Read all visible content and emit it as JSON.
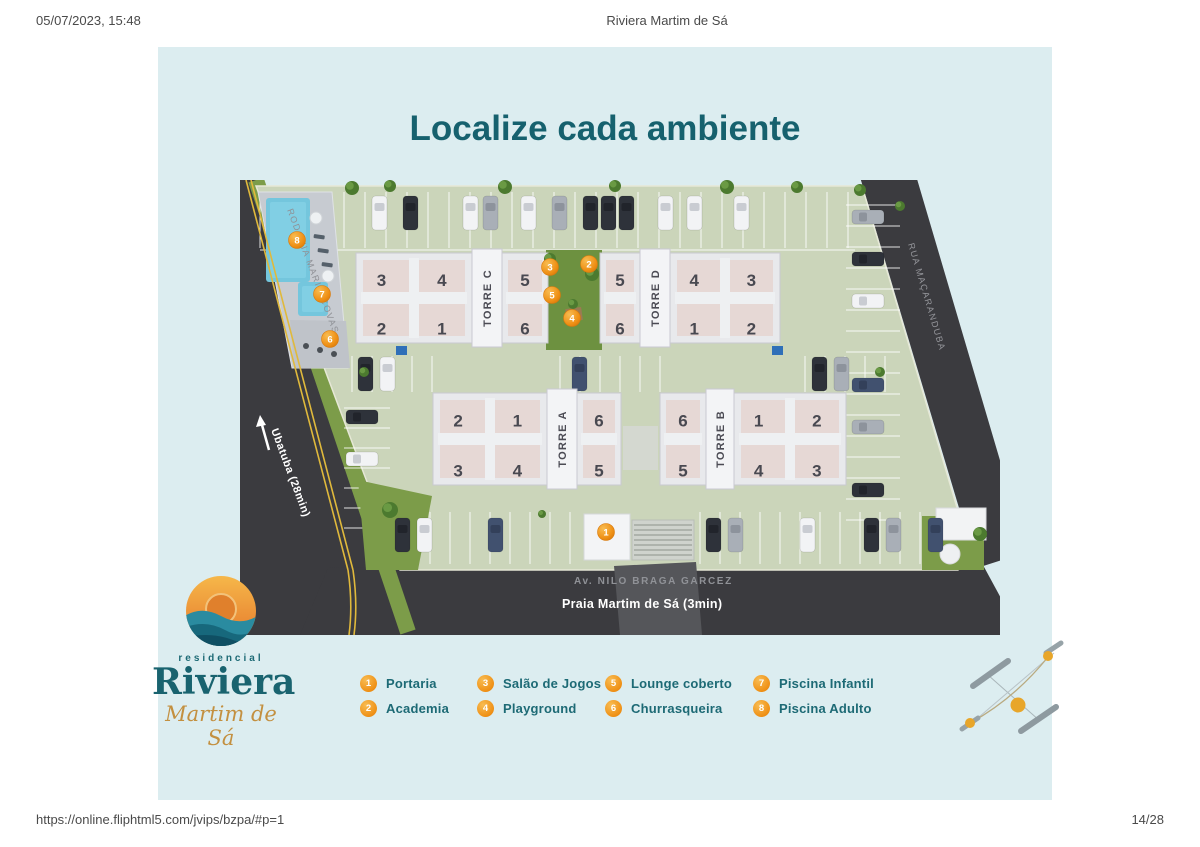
{
  "print_header": {
    "datetime": "05/07/2023, 15:48",
    "title": "Riviera Martim de Sá"
  },
  "print_footer": {
    "url": "https://online.fliphtml5.com/jvips/bzpa/#p=1",
    "page_indicator": "14/28"
  },
  "poster": {
    "title": "Localize cada ambiente",
    "logo": {
      "line1": "residencial",
      "line2": "Riviera",
      "line3": "Martim de Sá"
    },
    "roads": {
      "left": {
        "name": "RODOVIA MARIO COVAS",
        "destination": "Ubatuba (28min)"
      },
      "right": {
        "name": "RUA MAÇARANDUBA"
      },
      "bottom": {
        "name": "Av. NILO BRAGA GARCEZ",
        "destination": "Praia Martim de Sá (3min)"
      }
    },
    "towers": [
      {
        "label": "TORRE C",
        "big_wing_side": "left",
        "big_units": [
          "3",
          "4",
          "2",
          "1"
        ],
        "small_units": [
          "5",
          "6"
        ]
      },
      {
        "label": "TORRE D",
        "big_wing_side": "right",
        "big_units": [
          "4",
          "3",
          "1",
          "2"
        ],
        "small_units": [
          "5",
          "6"
        ]
      },
      {
        "label": "TORRE A",
        "big_wing_side": "left",
        "big_units": [
          "2",
          "1",
          "3",
          "4"
        ],
        "small_units": [
          "6",
          "5"
        ]
      },
      {
        "label": "TORRE B",
        "big_wing_side": "right",
        "big_units": [
          "1",
          "2",
          "4",
          "3"
        ],
        "small_units": [
          "6",
          "5"
        ]
      }
    ],
    "map_markers": [
      {
        "n": "1",
        "x": 366,
        "y": 352
      },
      {
        "n": "2",
        "x": 349,
        "y": 84
      },
      {
        "n": "3",
        "x": 310,
        "y": 87
      },
      {
        "n": "4",
        "x": 332,
        "y": 138
      },
      {
        "n": "5",
        "x": 312,
        "y": 115
      },
      {
        "n": "6",
        "x": 90,
        "y": 159
      },
      {
        "n": "7",
        "x": 82,
        "y": 114
      },
      {
        "n": "8",
        "x": 57,
        "y": 60
      }
    ],
    "legend": [
      {
        "n": "1",
        "label": "Portaria"
      },
      {
        "n": "2",
        "label": "Academia"
      },
      {
        "n": "3",
        "label": "Salão de Jogos"
      },
      {
        "n": "4",
        "label": "Playground"
      },
      {
        "n": "5",
        "label": "Lounge coberto"
      },
      {
        "n": "6",
        "label": "Churrasqueira"
      },
      {
        "n": "7",
        "label": "Piscina Infantil"
      },
      {
        "n": "8",
        "label": "Piscina Adulto"
      }
    ],
    "colors": {
      "accent_teal": "#16616e",
      "accent_orange": "#ef9015",
      "panel_bg": "#dcedf0"
    }
  }
}
